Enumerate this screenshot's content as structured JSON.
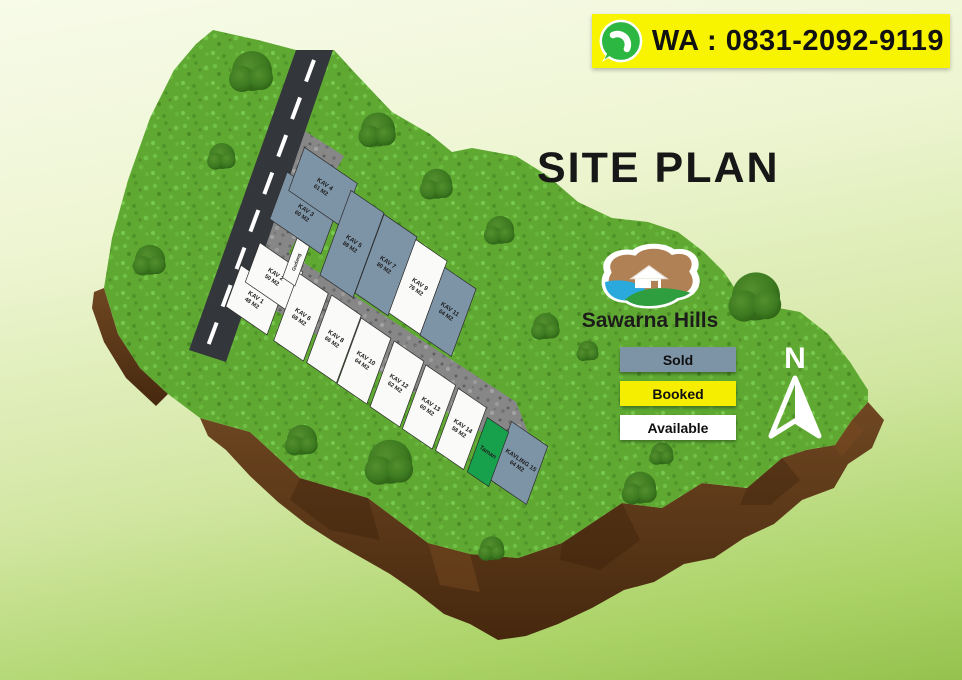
{
  "banner": {
    "label": "WA : 0831-2092-9119",
    "icon": "whatsapp-icon",
    "background": "#f8f400"
  },
  "title": "SITE PLAN",
  "brand": {
    "name": "Sawarna Hills"
  },
  "compass": {
    "label": "N"
  },
  "legend": [
    {
      "label": "Sold",
      "color": "#7d93a6"
    },
    {
      "label": "Booked",
      "color": "#f6ee00"
    },
    {
      "label": "Available",
      "color": "#ffffff"
    }
  ],
  "colors": {
    "sold": "#7d93a6",
    "available": "#fafaf8",
    "park": "#18a14c",
    "facility": "#fafaf8",
    "plot_border": "#2b2b2b",
    "road": "#33363b",
    "grass": "#5fa933",
    "dirt": "#5d3a1b"
  },
  "plots": [
    {
      "id": "k1",
      "name": "KAV 1",
      "area": "48 M2",
      "status": "available"
    },
    {
      "id": "k2",
      "name": "KAV 2",
      "area": "50 M2",
      "status": "available"
    },
    {
      "id": "k3",
      "name": "KAV 3",
      "area": "60 M2",
      "status": "sold"
    },
    {
      "id": "k4",
      "name": "KAV 4",
      "area": "61 M2",
      "status": "sold"
    },
    {
      "id": "k5",
      "name": "KAV 5",
      "area": "88 M2",
      "status": "sold"
    },
    {
      "id": "k6",
      "name": "KAV 6",
      "area": "68 M2",
      "status": "available"
    },
    {
      "id": "k7",
      "name": "KAV 7",
      "area": "80 M2",
      "status": "sold"
    },
    {
      "id": "k8",
      "name": "KAV 8",
      "area": "66 M2",
      "status": "available"
    },
    {
      "id": "k9",
      "name": "KAV 9",
      "area": "76 M2",
      "status": "available"
    },
    {
      "id": "k10",
      "name": "KAV 10",
      "area": "64 M2",
      "status": "available"
    },
    {
      "id": "k11",
      "name": "KAV 11",
      "area": "64 M2",
      "status": "sold"
    },
    {
      "id": "k12",
      "name": "KAV 12",
      "area": "62 M2",
      "status": "available"
    },
    {
      "id": "k13",
      "name": "KAV 13",
      "area": "60 M2",
      "status": "available"
    },
    {
      "id": "k14",
      "name": "KAV 14",
      "area": "58 M2",
      "status": "available"
    },
    {
      "id": "k15",
      "name": "KAVLING 15",
      "area": "64 M2",
      "status": "sold"
    },
    {
      "id": "taman",
      "name": "Taman",
      "area": "",
      "status": "park"
    },
    {
      "id": "gudang",
      "name": "Gudang",
      "area": "",
      "status": "facility"
    }
  ]
}
